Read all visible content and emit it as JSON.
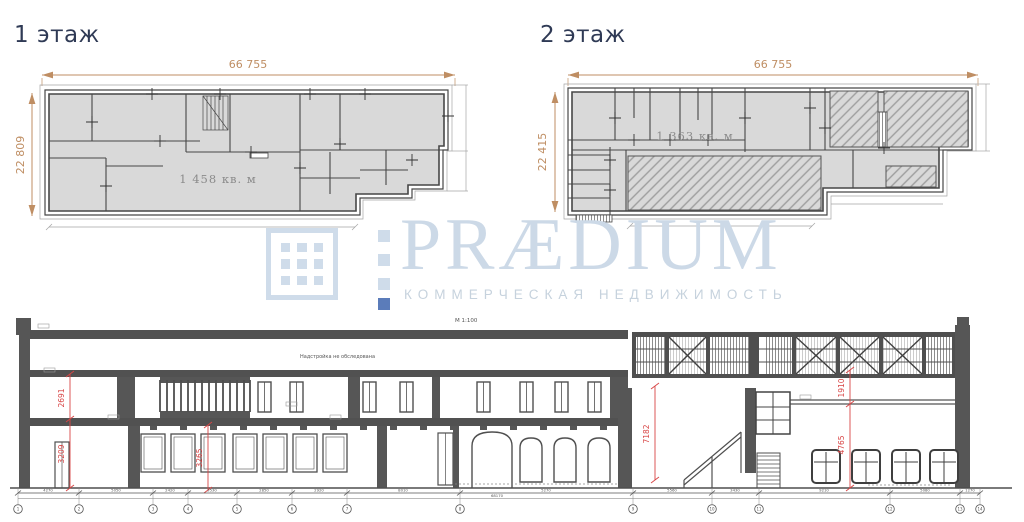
{
  "floor1": {
    "title": "1 этаж",
    "width": "66 755",
    "height": "22 809",
    "area": "1 458 кв. м"
  },
  "floor2": {
    "title": "2 этаж",
    "width": "66 755",
    "height": "22 415",
    "area": "1 363 кв. м"
  },
  "watermark": {
    "brand": "PRÆDIUM",
    "tagline": "КОММЕРЧЕСКАЯ НЕДВИЖИМОСТЬ",
    "light_color": "#cfdcea",
    "accent_color": "#5b7cba"
  },
  "colors": {
    "dim_accent": "#bf8e63",
    "red_dim": "#d84545",
    "wall": "#565656",
    "floor_fill": "#d9d9d9"
  },
  "section": {
    "scale": "М 1:100",
    "note": "Надстройка не обследована",
    "dims": {
      "left_upper": "2691",
      "left_lower": "3209",
      "mid": "3265",
      "hall": "7182",
      "right_upper": "1910",
      "right_lower": "4765"
    },
    "chain": {
      "total": "68170",
      "segments": [
        "4270",
        "5050",
        "2420",
        "3530",
        "2850",
        "2920",
        "8010",
        "5270",
        "5560",
        "3430",
        "9210",
        "5080",
        "1270"
      ],
      "axes": [
        "1",
        "2",
        "3",
        "4",
        "5",
        "6",
        "7",
        "8",
        "9",
        "10",
        "11",
        "12",
        "13",
        "14"
      ]
    }
  }
}
